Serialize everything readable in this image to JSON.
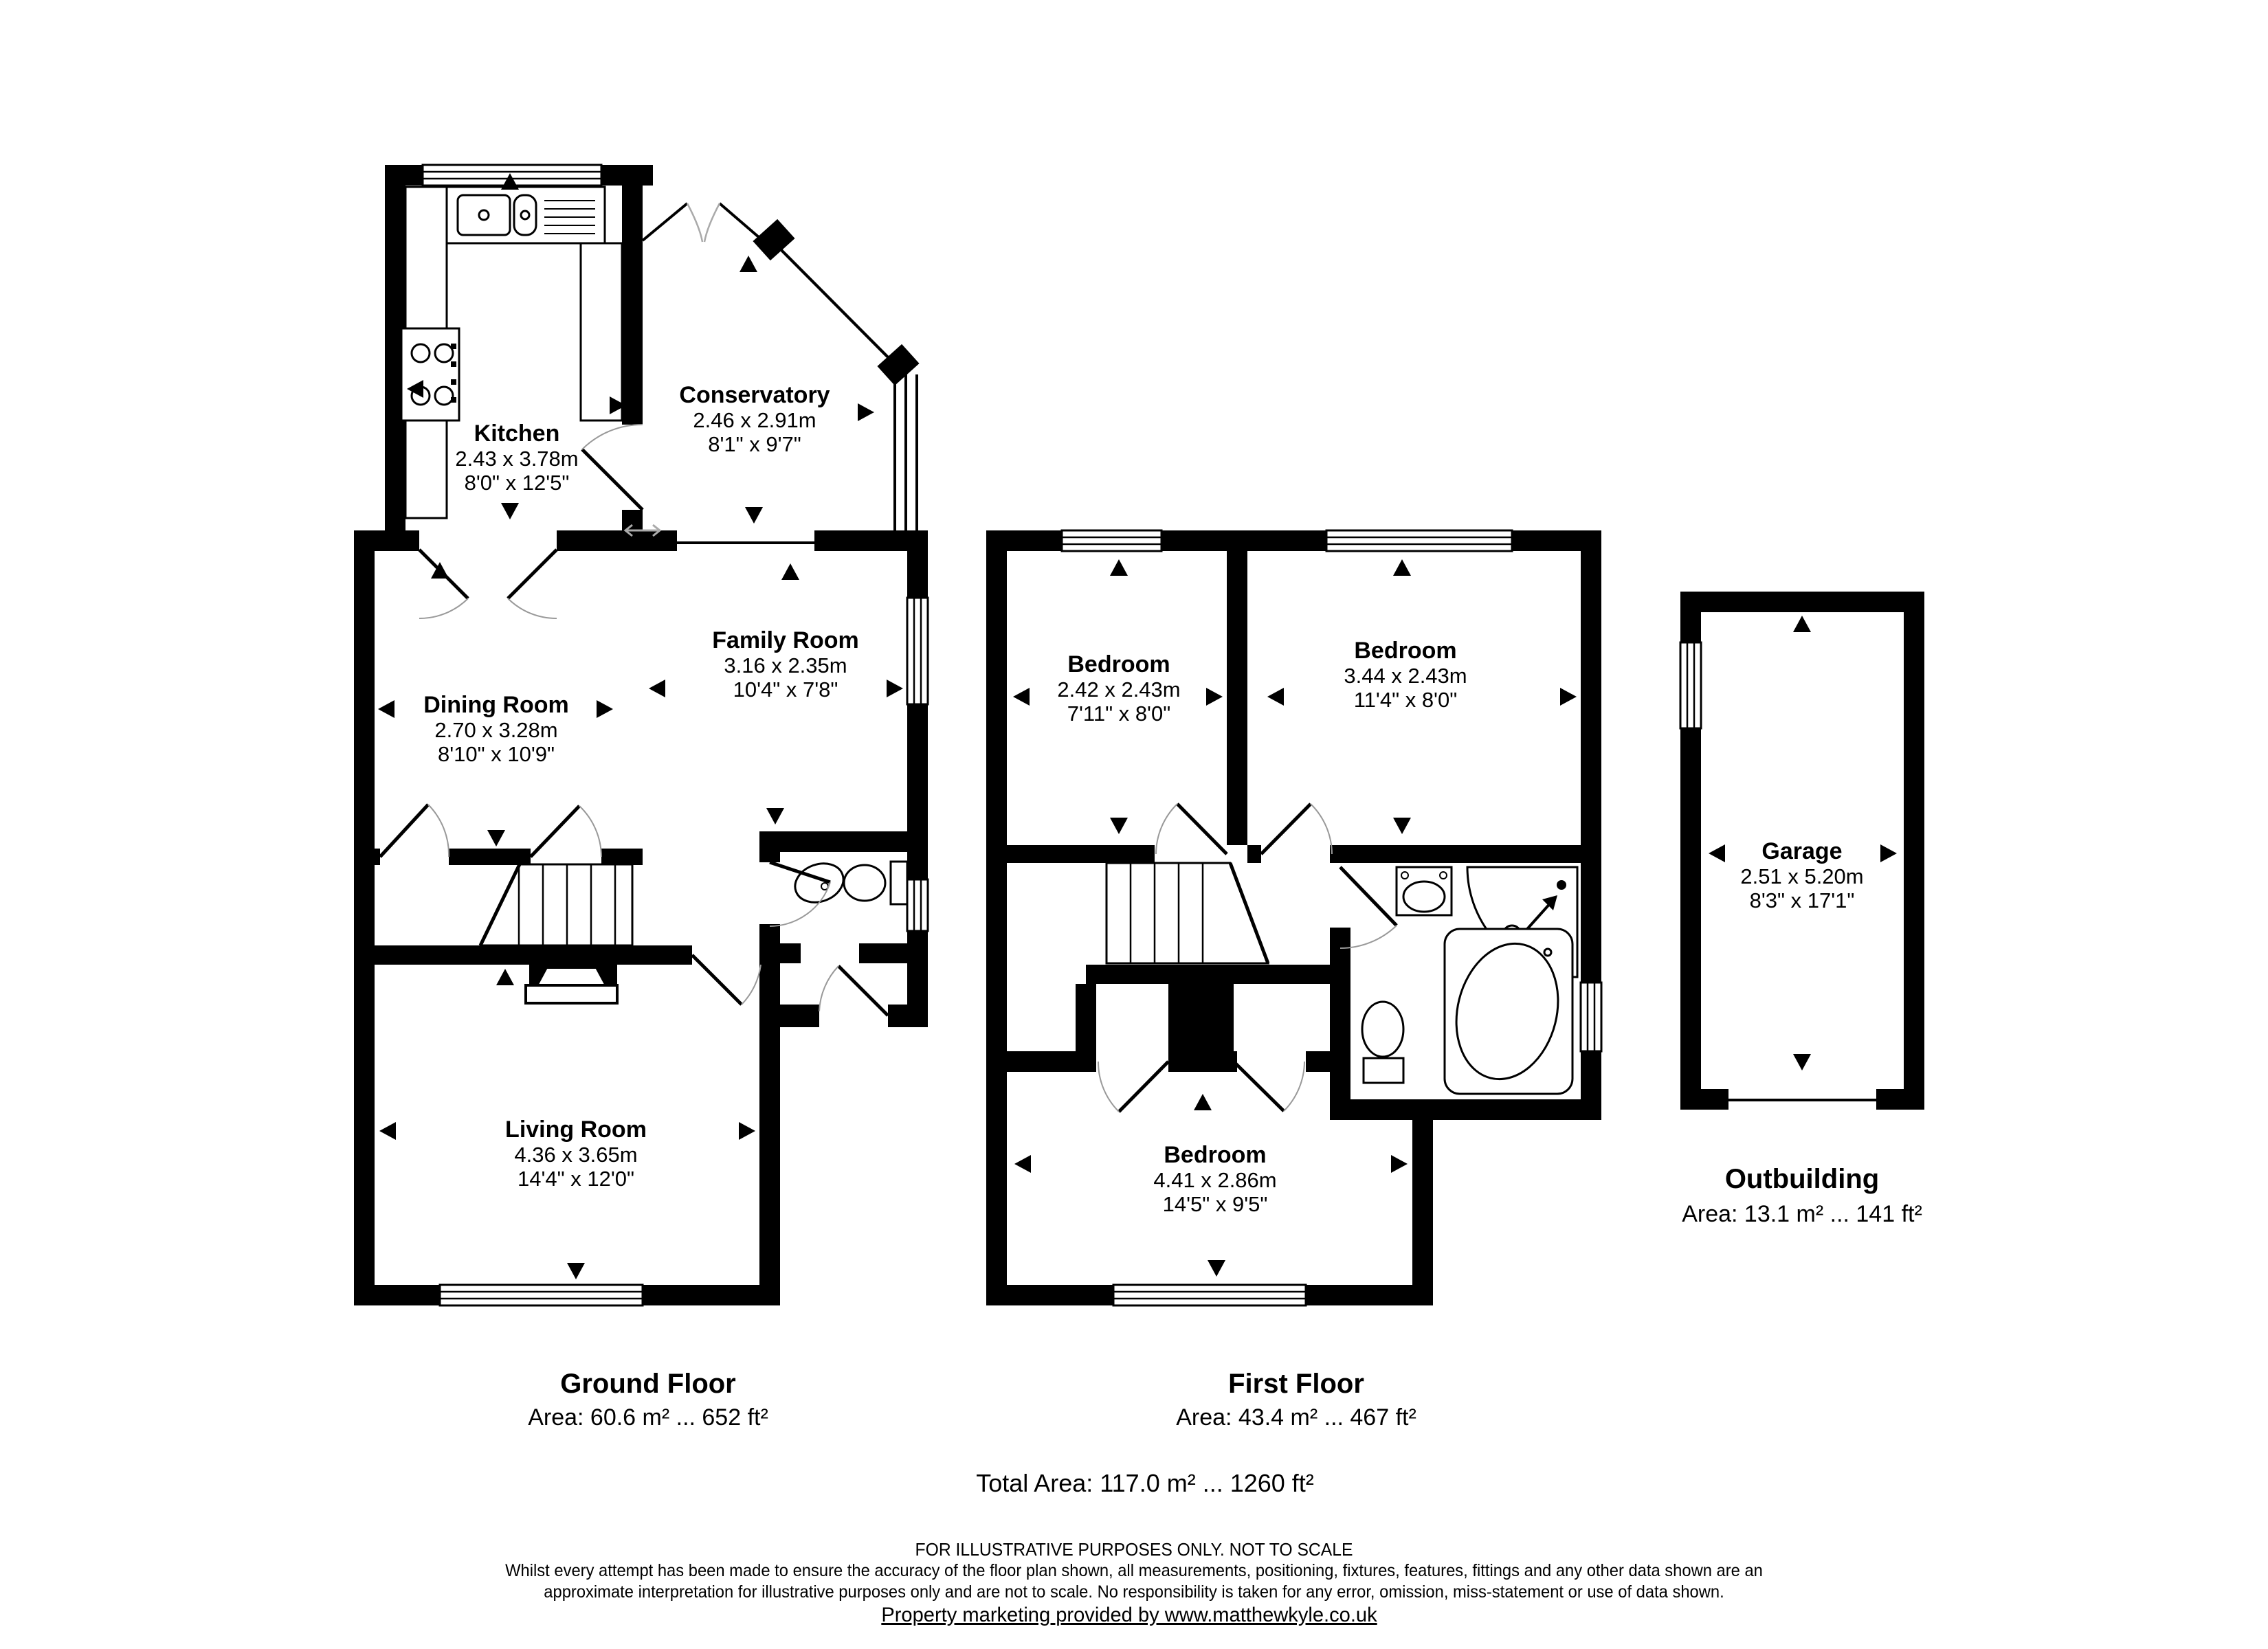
{
  "plan": {
    "rooms": [
      {
        "id": "kitchen",
        "name": "Kitchen",
        "metric": "2.43 x 3.78m",
        "imperial": "8'0\" x 12'5\""
      },
      {
        "id": "conservatory",
        "name": "Conservatory",
        "metric": "2.46 x 2.91m",
        "imperial": "8'1\" x 9'7\""
      },
      {
        "id": "dining-room",
        "name": "Dining Room",
        "metric": "2.70 x 3.28m",
        "imperial": "8'10\" x 10'9\""
      },
      {
        "id": "family-room",
        "name": "Family Room",
        "metric": "3.16 x 2.35m",
        "imperial": "10'4\" x 7'8\""
      },
      {
        "id": "living-room",
        "name": "Living Room",
        "metric": "4.36 x 3.65m",
        "imperial": "14'4\" x 12'0\""
      },
      {
        "id": "bedroom-1",
        "name": "Bedroom",
        "metric": "2.42 x 2.43m",
        "imperial": "7'11\" x 8'0\""
      },
      {
        "id": "bedroom-2",
        "name": "Bedroom",
        "metric": "3.44 x 2.43m",
        "imperial": "11'4\" x 8'0\""
      },
      {
        "id": "bedroom-3",
        "name": "Bedroom",
        "metric": "4.41 x 2.86m",
        "imperial": "14'5\" x 9'5\""
      },
      {
        "id": "garage",
        "name": "Garage",
        "metric": "2.51 x 5.20m",
        "imperial": "8'3\" x 17'1\""
      }
    ],
    "floors": [
      {
        "label": "Ground Floor",
        "area": "Area: 60.6 m² ... 652 ft²"
      },
      {
        "label": "First Floor",
        "area": "Area: 43.4 m² ... 467 ft²"
      },
      {
        "label": "Outbuilding",
        "area": "Area: 13.1 m² ... 141 ft²"
      }
    ],
    "total_area": "Total Area: 117.0 m² ... 1260 ft²"
  },
  "footer": {
    "notice": "FOR ILLUSTRATIVE PURPOSES ONLY. NOT TO SCALE",
    "disclaimer_line1": "Whilst every attempt has been made to ensure the accuracy of the floor plan shown, all measurements, positioning, fixtures, features, fittings and any other data shown are an",
    "disclaimer_line2": "approximate interpretation for illustrative purposes only and are not to scale. No responsibility is taken for any error, omission, miss-statement or use of data shown.",
    "credit": "Property marketing provided by www.matthewkyle.co.uk"
  },
  "colors": {
    "wall": "#000000",
    "background": "#ffffff",
    "door_arc": "#999999",
    "slide_arrow": "#aaaaaa"
  }
}
